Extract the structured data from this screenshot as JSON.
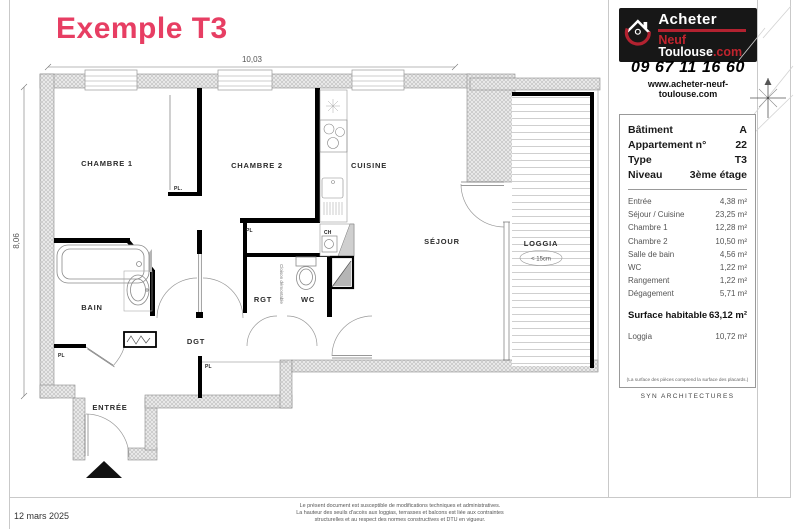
{
  "title": "Exemple T3",
  "branding": {
    "name_top": "Acheter",
    "name_red": "Neuf",
    "name_white": "Toulouse",
    "name_suffix": ".com",
    "phone": "09 67 11 16 60",
    "website": "www.acheter-neuf-toulouse.com"
  },
  "info_panel": {
    "header_rows": [
      {
        "label": "Bâtiment",
        "value": "A"
      },
      {
        "label": "Appartement n°",
        "value": "22"
      },
      {
        "label": "Type",
        "value": "T3"
      },
      {
        "label": "Niveau",
        "value": "3ème étage"
      }
    ],
    "room_rows": [
      {
        "label": "Entrée",
        "value": "4,38 m²"
      },
      {
        "label": "Séjour / Cuisine",
        "value": "23,25 m²"
      },
      {
        "label": "Chambre 1",
        "value": "12,28 m²"
      },
      {
        "label": "Chambre 2",
        "value": "10,50 m²"
      },
      {
        "label": "Salle de bain",
        "value": "4,56 m²"
      },
      {
        "label": "WC",
        "value": "1,22 m²"
      },
      {
        "label": "Rangement",
        "value": "1,22 m²"
      },
      {
        "label": "Dégagement",
        "value": "5,71 m²"
      }
    ],
    "surface_row": {
      "label": "Surface habitable",
      "value": "63,12 m²"
    },
    "loggia_row": {
      "label": "Loggia",
      "value": "10,72 m²"
    },
    "note": "(La surface des pièces comprend la surface des placards.)",
    "architect": "SYN ARCHITECTURES"
  },
  "plan": {
    "rooms": {
      "chambre1": "CHAMBRE 1",
      "chambre2": "CHAMBRE 2",
      "cuisine": "CUISINE",
      "sejour": "SÉJOUR",
      "loggia": "LOGGIA",
      "bain": "BAIN",
      "rgt": "RGT",
      "wc": "WC",
      "dgt": "DGT",
      "entree": "ENTRÉE"
    },
    "labels": {
      "pl": "PL",
      "pl_dot": "PL.",
      "ch": "CH",
      "cloison": "Cloison démontable",
      "loggia_depth": "< 15cm"
    },
    "dimensions": {
      "width": "10,03",
      "height": "8,06"
    }
  },
  "footer": {
    "date": "12 mars 2025",
    "disclaimer": [
      "Le présent document est susceptible de modifications techniques et administratives.",
      "La hauteur des seuils d'accès aux loggias, terrasses et balcons est liée aux contraintes",
      "structurelles et au respect des normes constructives et DTU en vigueur."
    ]
  },
  "colors": {
    "accent": "#e73e63",
    "logo_red": "#b22230",
    "logo_bg": "#171717"
  }
}
